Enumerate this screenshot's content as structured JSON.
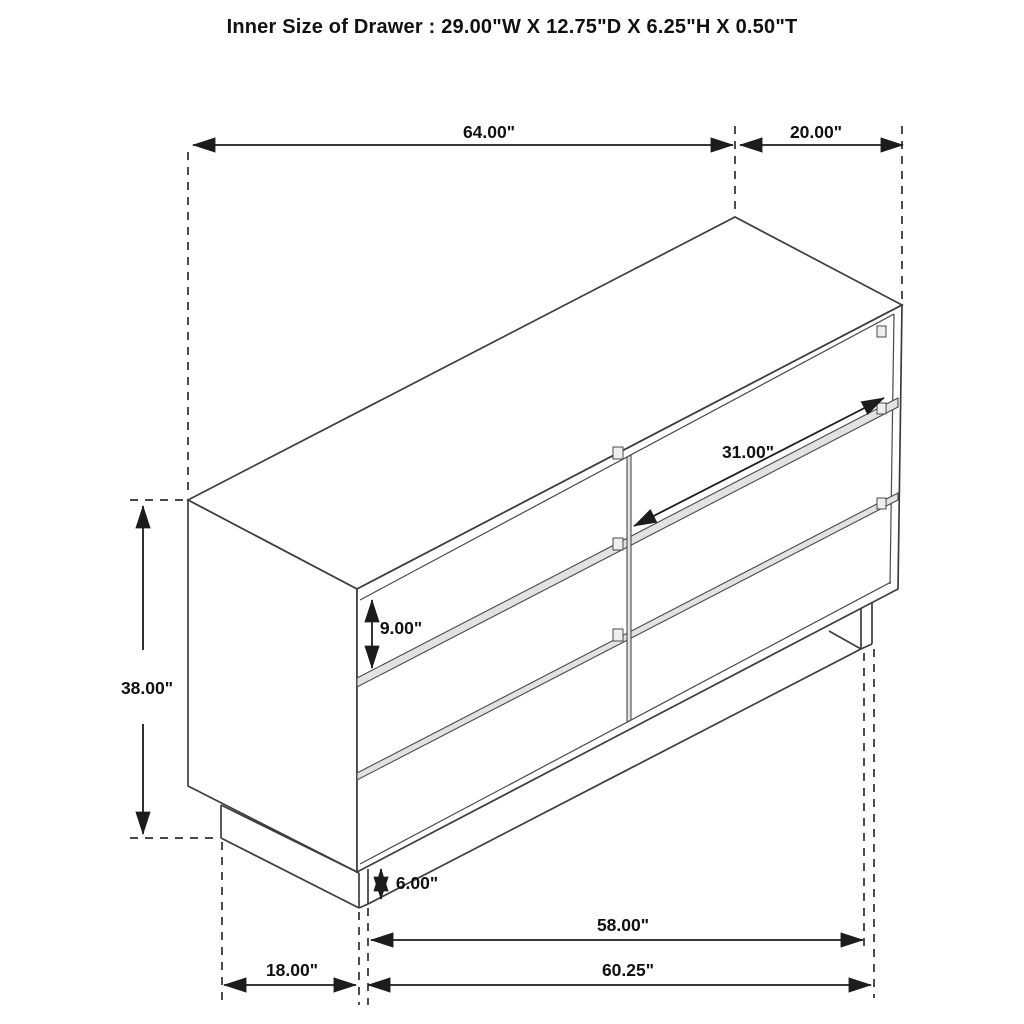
{
  "title": "Inner Size of Drawer : 29.00\"W X 12.75\"D X 6.25\"H X 0.50\"T",
  "figure": {
    "object": "six-drawer-dresser-isometric-dimension-drawing",
    "colors": {
      "line": "#3d3d3d",
      "dimension_line": "#1c1c1c",
      "label_text": "#111111",
      "background": "#ffffff",
      "drawer_gap_fill": "#e2e2e2"
    },
    "dims": {
      "top_width": {
        "label": "64.00\""
      },
      "top_depth": {
        "label": "20.00\""
      },
      "drawer_width": {
        "label": "31.00\""
      },
      "overall_height": {
        "label": "38.00\""
      },
      "drawer_height": {
        "label": "9.00\""
      },
      "leg_height": {
        "label": "6.00\""
      },
      "base_inner_width": {
        "label": "58.00\""
      },
      "base_outer_width": {
        "label": "60.25\""
      },
      "side_base_depth": {
        "label": "18.00\""
      }
    }
  }
}
